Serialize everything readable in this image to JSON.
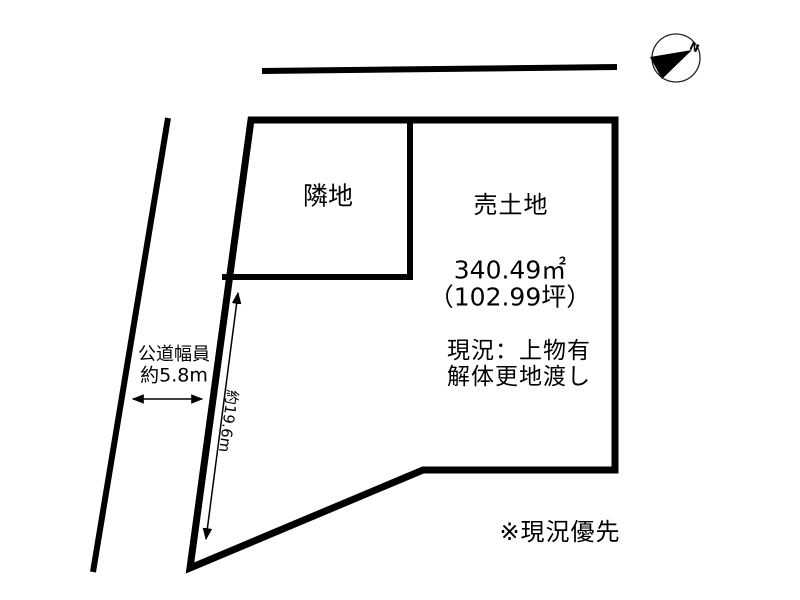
{
  "colors": {
    "line": "#000000",
    "background": "#ffffff"
  },
  "compass": {
    "north_label": "N"
  },
  "parcels": {
    "neighbor_label": "隣地",
    "sale_label": "売土地",
    "area_sqm": "340.49㎡",
    "area_tsubo": "（102.99坪）",
    "condition_line1": "現況：上物有",
    "condition_line2": "解体更地渡し"
  },
  "dimensions": {
    "road_width_label": "公道幅員",
    "road_width_value": "約5.8m",
    "frontage_value": "約19.6m"
  },
  "note": "※現況優先"
}
